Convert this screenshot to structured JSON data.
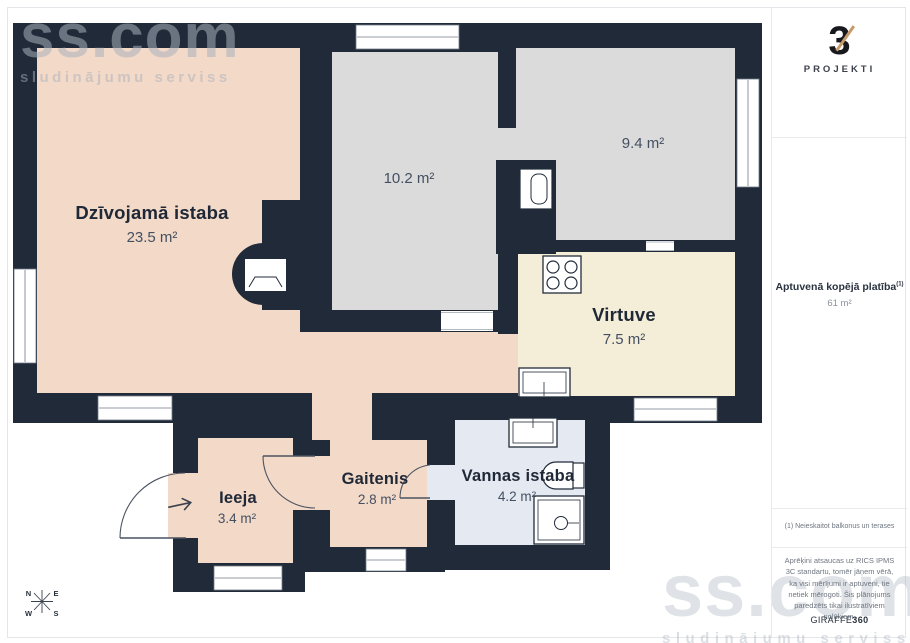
{
  "page": {
    "watermark_top": {
      "brand": "ss.com",
      "tagline": "sludinājumu serviss"
    },
    "watermark_bottom": {
      "brand": "ss.com",
      "tagline": "sludinājumu serviss"
    }
  },
  "floorplan": {
    "rooms": {
      "living": {
        "name": "Dzīvojamā istaba",
        "area": "23.5 m²"
      },
      "room_a": {
        "area": "10.2 m²"
      },
      "room_b": {
        "area": "9.4 m²"
      },
      "kitchen": {
        "name": "Virtuve",
        "area": "7.5 m²"
      },
      "entry": {
        "name": "Ieeja",
        "area": "3.4 m²"
      },
      "hallway": {
        "name": "Gaitenis",
        "area": "2.8 m²"
      },
      "bathroom": {
        "name": "Vannas istaba",
        "area": "4.2 m²"
      }
    },
    "compass": {
      "north": "N",
      "east": "E",
      "south": "S",
      "west": "W"
    }
  },
  "sidebar": {
    "logo": {
      "numeral": "3",
      "wordmark": "PROJEKTI"
    },
    "total_area": {
      "label": "Aptuvenā kopējā platība",
      "footnote_ref": "(1)",
      "value": "61 m²"
    },
    "footnote": "(1) Neieskaitot balkonus un terases",
    "disclaimer": "Aprēķini atsaucas uz RICS IPMS 3C standartu, tomēr jāņem vērā, ka visi mērījumi ir aptuveni, tie netiek mērogoti. Šis plānojums paredzēts tikai ilustratīviem nolūkiem.",
    "vendor": {
      "name": "GIRAFFE",
      "suffix": "360"
    }
  },
  "colors": {
    "wall": "#212A38",
    "living_fill": "#F3D9C8",
    "bedroom_fill": "#DBDBDB",
    "kitchen_fill": "#F4EDD8",
    "bathroom_fill": "#E4E9F2",
    "logo_accent": "#C69A6B",
    "page_border": "#E4E6E9"
  }
}
